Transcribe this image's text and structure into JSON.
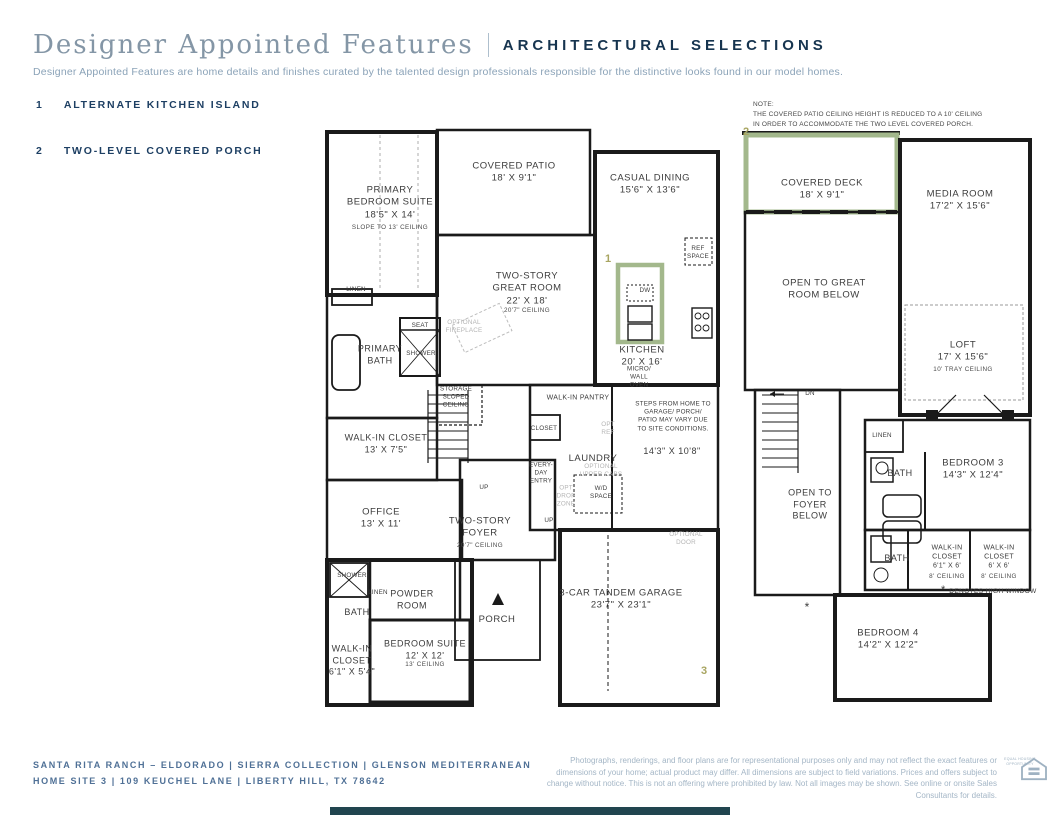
{
  "header": {
    "title": "Designer Appointed Features",
    "divider": "|",
    "section": "ARCHITECTURAL SELECTIONS",
    "description": "Designer Appointed Features are home details and finishes curated by the talented design professionals responsible for the distinctive looks found in our model homes."
  },
  "features": [
    {
      "number": "1",
      "label": "ALTERNATE KITCHEN ISLAND"
    },
    {
      "number": "2",
      "label": "TWO-LEVEL COVERED PORCH"
    }
  ],
  "plan_note": "NOTE:\nTHE COVERED PATIO CEILING HEIGHT IS REDUCED TO A 10' CEILING\nIN ORDER TO ACCOMMODATE THE TWO LEVEL COVERED PORCH.",
  "markers": {
    "kitchen_island": "1",
    "covered_deck": "2",
    "garage_corner": "3"
  },
  "floor1": {
    "primary_suite": "PRIMARY\nBEDROOM SUITE\n18'5\" X 14'",
    "primary_suite_sub": "SLOPE TO 13' CEILING",
    "covered_patio": "COVERED PATIO\n18' X 9'1\"",
    "casual_dining": "CASUAL DINING\n15'6\" X 13'6\"",
    "great_room": "TWO-STORY\nGREAT ROOM\n22' X 18'",
    "great_room_sub": "20'7\" CEILING",
    "kitchen": "KITCHEN\n20' X 16'",
    "ref_space": "REF\nSPACE",
    "dw": "DW",
    "micro_wall_oven": "MICRO/\nWALL\nOVEN",
    "linen_a": "LINEN",
    "seat": "SEAT",
    "shower_a": "SHOWER",
    "optional_fireplace": "OPTIONAL\nFIREPLACE",
    "primary_bath": "PRIMARY\nBATH",
    "storage": "STORAGE\nSLOPED\nCEILING",
    "walk_in_closet_a": "WALK-IN CLOSET\n13' X 7'5\"",
    "walk_in_pantry": "WALK-IN PANTRY",
    "closet": "CLOSET",
    "opt_ref": "OPT\nREF",
    "laundry": "LAUNDRY",
    "every_day_entry": "EVERY-\nDAY\nENTRY",
    "optional_upper_cabs": "OPTIONAL\nUPPER CABS",
    "wd_space": "W/D\nSPACE",
    "opt_drop_zone": "OPT\nDROP\nZONE",
    "up_a": "UP",
    "up_b": "UP",
    "steps_note": "STEPS FROM HOME TO\nGARAGE/ PORCH/\nPATIO MAY VARY DUE\nTO SITE CONDITIONS.",
    "mud_dim": "14'3\" X 10'8\"",
    "office": "OFFICE\n13' X 11'",
    "foyer": "TWO-STORY\nFOYER",
    "foyer_sub": "20'7\" CEILING",
    "shower_b": "SHOWER",
    "linen_b": "LINEN",
    "powder_room": "POWDER\nROOM",
    "bath": "BATH",
    "walk_in_closet_b": "WALK-IN\nCLOSET\n6'1\" X 5'4\"",
    "bedroom_suite": "BEDROOM SUITE\n12' X 12'",
    "bedroom_suite_sub": "13' CEILING",
    "porch": "PORCH",
    "garage": "3-CAR TANDEM GARAGE\n23'7\" X 23'1\"",
    "optional_door": "OPTIONAL\nDOOR"
  },
  "floor2": {
    "covered_deck": "COVERED DECK\n18' X 9'1\"",
    "media_room": "MEDIA ROOM\n17'2\" X 15'6\"",
    "open_great": "OPEN TO GREAT\nROOM BELOW",
    "loft": "LOFT\n17' X 15'6\"",
    "loft_sub": "10' TRAY CEILING",
    "dn": "DN",
    "open_foyer": "OPEN TO\nFOYER\nBELOW",
    "linen": "LINEN",
    "bath_a": "BATH",
    "bedroom3": "BEDROOM 3\n14'3\" X 12'4\"",
    "bath_b": "BATH",
    "wic_a": "WALK-IN\nCLOSET\n6'1\" X 6'",
    "wic_a_sub": "8' CEILING",
    "wic_b": "WALK-IN\nCLOSET\n6' X 6'",
    "wic_b_sub": "8' CEILING",
    "high_window_mark": "*",
    "high_window_text": "DENOTES HIGH WINDOW",
    "window_asterisk": "*",
    "bedroom4": "BEDROOM 4\n14'2\" X 12'2\""
  },
  "footer": {
    "line1": "SANTA RITA RANCH – ELDORADO  |  SIERRA COLLECTION  |  GLENSON MEDITERRANEAN",
    "line2": "HOME SITE 3  |  109 KEUCHEL LANE  |  LIBERTY HILL, TX 78642",
    "disclaimer": "Photographs, renderings, and floor plans are for representational purposes only and may not reflect the exact features or dimensions of your home; actual product may differ. All dimensions are subject to field variations. Prices and offers subject to change without notice. This is not an offering where prohibited by law. Not all images may be shown. See online or onsite Sales Consultants for details.",
    "eho_label": "EQUAL HOUSING\nOPPORTUNITY"
  },
  "colors": {
    "navy": "#1d3f63",
    "title_gray_blue": "#8496a6",
    "accent_green": "#a3b88c",
    "marker_olive": "#a8a561",
    "wall_black": "#1a1a1a",
    "muted_text": "#9db0c2"
  }
}
